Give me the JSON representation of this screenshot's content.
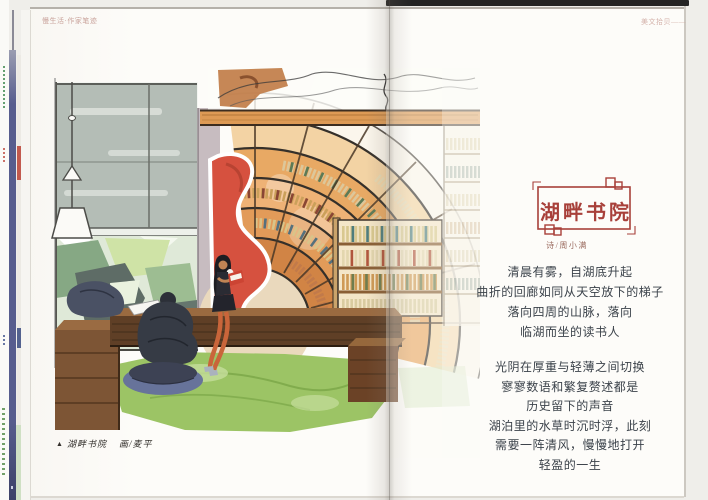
{
  "masthead": {
    "left": "慢生活·作家笔迹",
    "right": "美文拾贝——"
  },
  "article": {
    "title": "湖畔书院",
    "byline": "诗/周小满",
    "stanza1": [
      "清晨有雾，自湖底升起",
      "曲折的回廊如同从天空放下的梯子",
      "落向四周的山脉，落向",
      "临湖而坐的读书人"
    ],
    "stanza2": [
      "光阴在厚重与轻薄之间切换",
      "寥寥数语和繁复赘述都是",
      "历史留下的声音",
      "湖泊里的水草时沉时浮，此刻",
      "需要一阵清风，慢慢地打开",
      "轻盈的一生"
    ]
  },
  "caption": {
    "marker": "▲",
    "title": "湖畔书院",
    "credit": "画/麦平"
  },
  "colors": {
    "accent_red": "#a8403a",
    "poem_text": "#3b424a",
    "pod_red": "#d6513f",
    "shelf_orange": "#e29b59",
    "rug_green": "#9cc465",
    "spine_blue": "#575d8e"
  }
}
